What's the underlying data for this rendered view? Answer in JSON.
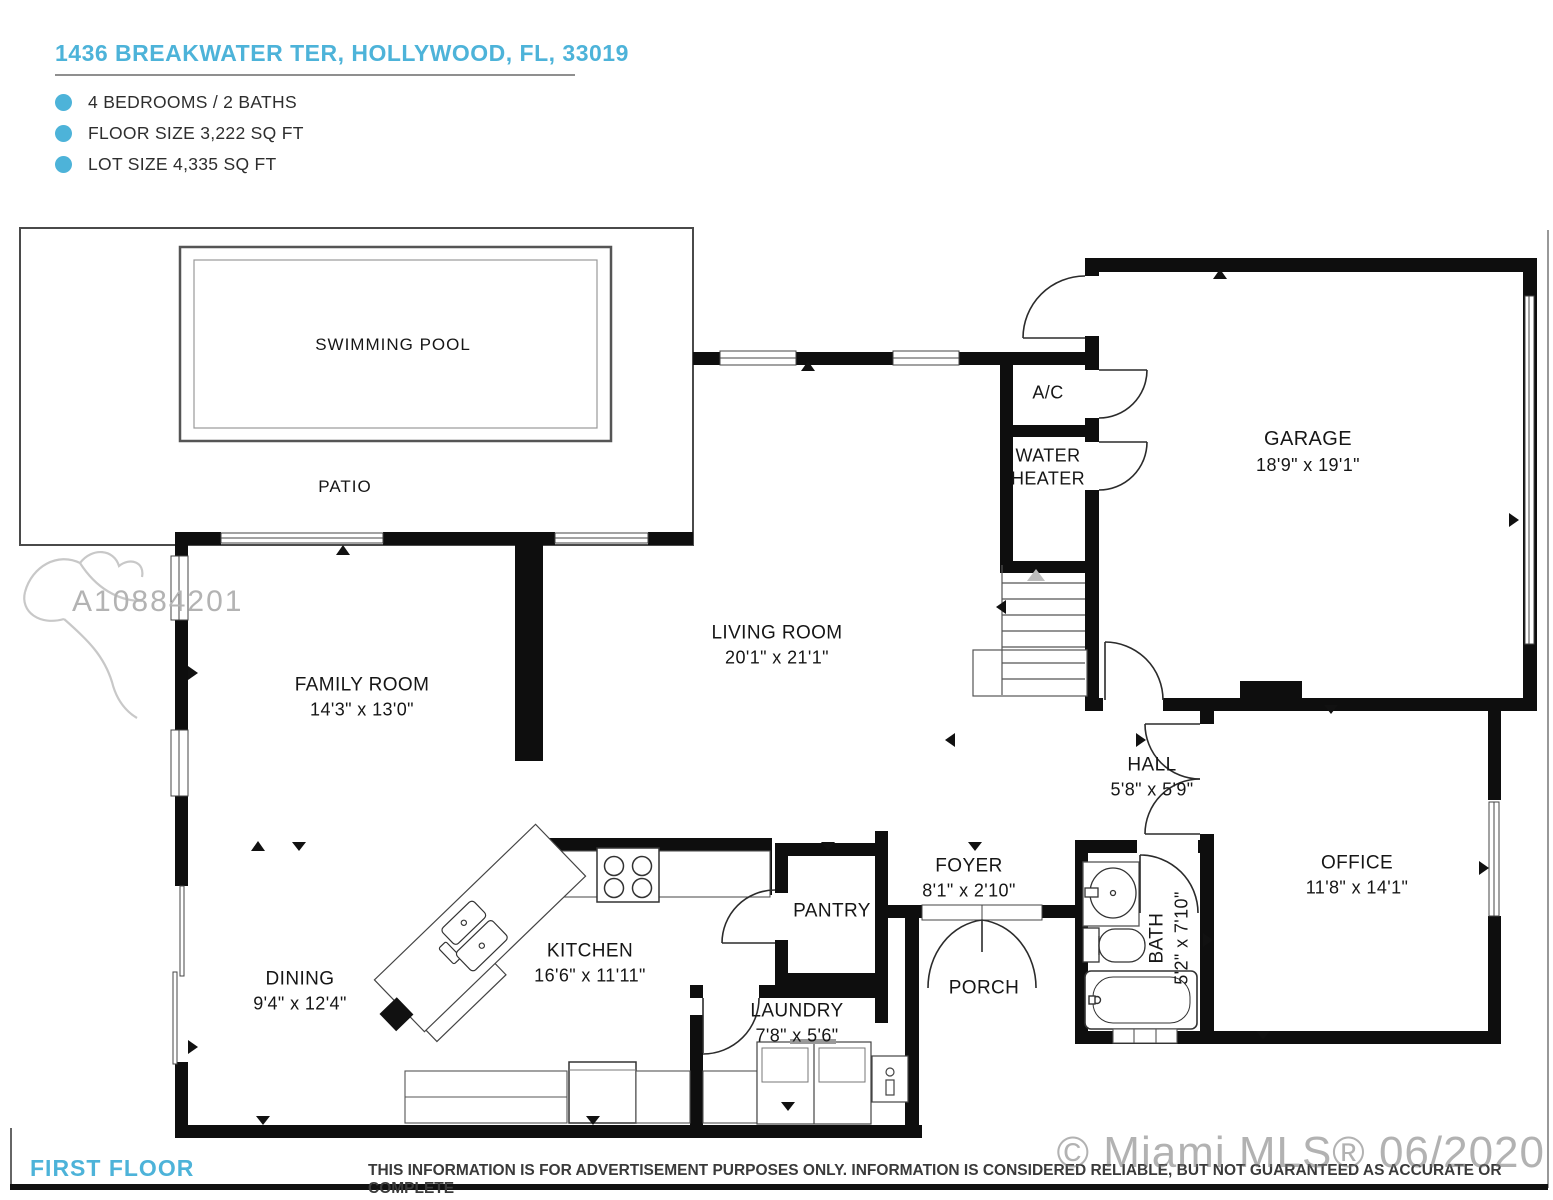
{
  "header": {
    "address": "1436 BREAKWATER TER, HOLLYWOOD, FL, 33019",
    "facts": [
      "4 BEDROOMS / 2 BATHS",
      "FLOOR SIZE 3,222 SQ FT",
      "LOT SIZE 4,335 SQ FT"
    ],
    "accent_color": "#4db3d9"
  },
  "rooms": {
    "swimming_pool": {
      "name": "SWIMMING POOL",
      "dims": ""
    },
    "patio": {
      "name": "PATIO",
      "dims": ""
    },
    "garage": {
      "name": "GARAGE",
      "dims": "18'9\" x 19'1\""
    },
    "ac": {
      "name": "A/C",
      "dims": ""
    },
    "water_heater": {
      "name": "WATER HEATER",
      "dims": ""
    },
    "living_room": {
      "name": "LIVING ROOM",
      "dims": "20'1\" x 21'1\""
    },
    "family_room": {
      "name": "FAMILY ROOM",
      "dims": "14'3\" x 13'0\""
    },
    "hall": {
      "name": "HALL",
      "dims": "5'8\" x 5'9\""
    },
    "office": {
      "name": "OFFICE",
      "dims": "11'8\" x 14'1\""
    },
    "foyer": {
      "name": "FOYER",
      "dims": "8'1\" x 2'10\""
    },
    "bath": {
      "name": "BATH",
      "dims": "5'2\" x 7'10\""
    },
    "pantry": {
      "name": "PANTRY",
      "dims": ""
    },
    "porch": {
      "name": "PORCH",
      "dims": ""
    },
    "kitchen": {
      "name": "KITCHEN",
      "dims": "16'6\" x 11'11\""
    },
    "dining": {
      "name": "DINING",
      "dims": "9'4\" x 12'4\""
    },
    "laundry": {
      "name": "LAUNDRY",
      "dims": "7'8\" x 5'6\""
    }
  },
  "watermarks": {
    "mls_number": "A10884201",
    "brand": "© Miami MLS® 06/2020"
  },
  "footer": {
    "floor_label": "FIRST FLOOR",
    "disclaimer": "THIS INFORMATION IS FOR ADVERTISEMENT PURPOSES ONLY. INFORMATION IS CONSIDERED RELIABLE, BUT NOT GUARANTEED AS ACCURATE OR COMPLETE"
  }
}
